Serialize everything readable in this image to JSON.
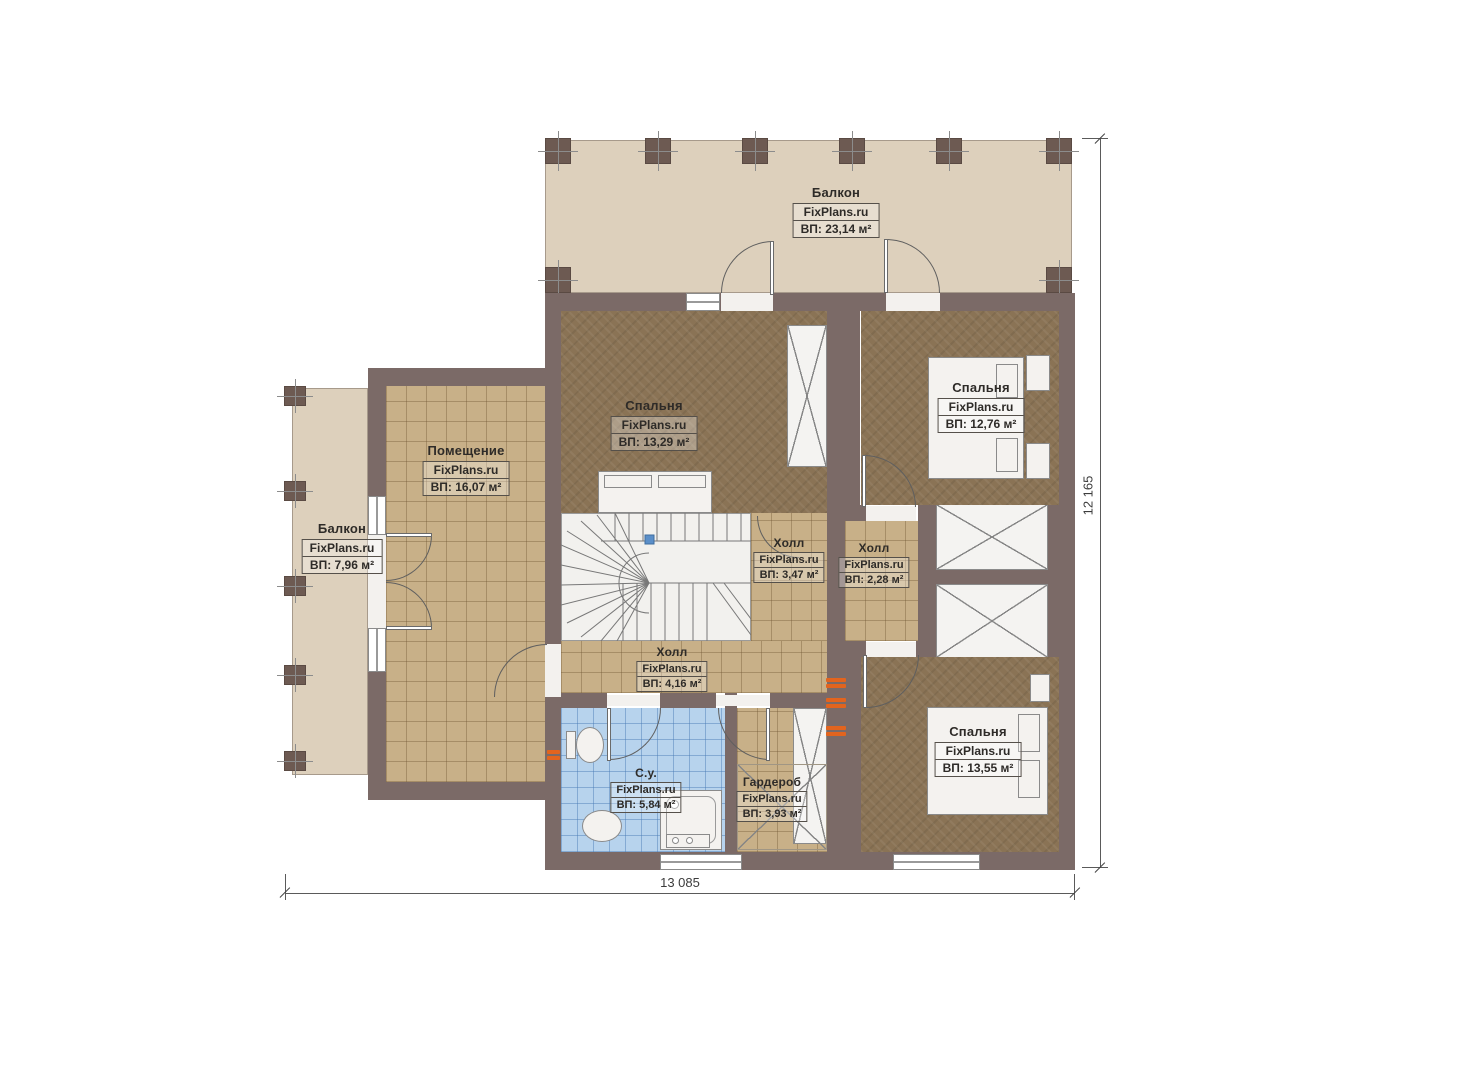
{
  "brand": "FixPlans.ru",
  "plan_title": "Floor plan, level 2",
  "rooms": [
    {
      "name": "Балкон",
      "area": "ВП: 23,14 м²"
    },
    {
      "name": "Спальня",
      "area": "ВП: 13,29 м²"
    },
    {
      "name": "Спальня",
      "area": "ВП: 12,76 м²"
    },
    {
      "name": "Помещение",
      "area": "ВП: 16,07 м²"
    },
    {
      "name": "Балкон",
      "area": "ВП: 7,96 м²"
    },
    {
      "name": "Холл",
      "area": "ВП: 3,47 м²"
    },
    {
      "name": "Холл",
      "area": "ВП: 2,28 м²"
    },
    {
      "name": "Холл",
      "area": "ВП: 4,16 м²"
    },
    {
      "name": "С.у.",
      "area": "ВП: 5,84 м²"
    },
    {
      "name": "Гардероб",
      "area": "ВП: 3,93 м²"
    },
    {
      "name": "Спальня",
      "area": "ВП: 13,55 м²"
    }
  ],
  "dimensions": {
    "width_label": "13 085",
    "height_label": "12 165"
  },
  "colors": {
    "wall": "#7b6a67",
    "balcony_floor": "#ddd0bc",
    "hall_floor": "#c8b088",
    "bedroom_floor": "#8a7355",
    "bathroom_floor": "#b7d3ed",
    "radiator": "#e2641e",
    "marker_blue": "#5b8fc9"
  }
}
